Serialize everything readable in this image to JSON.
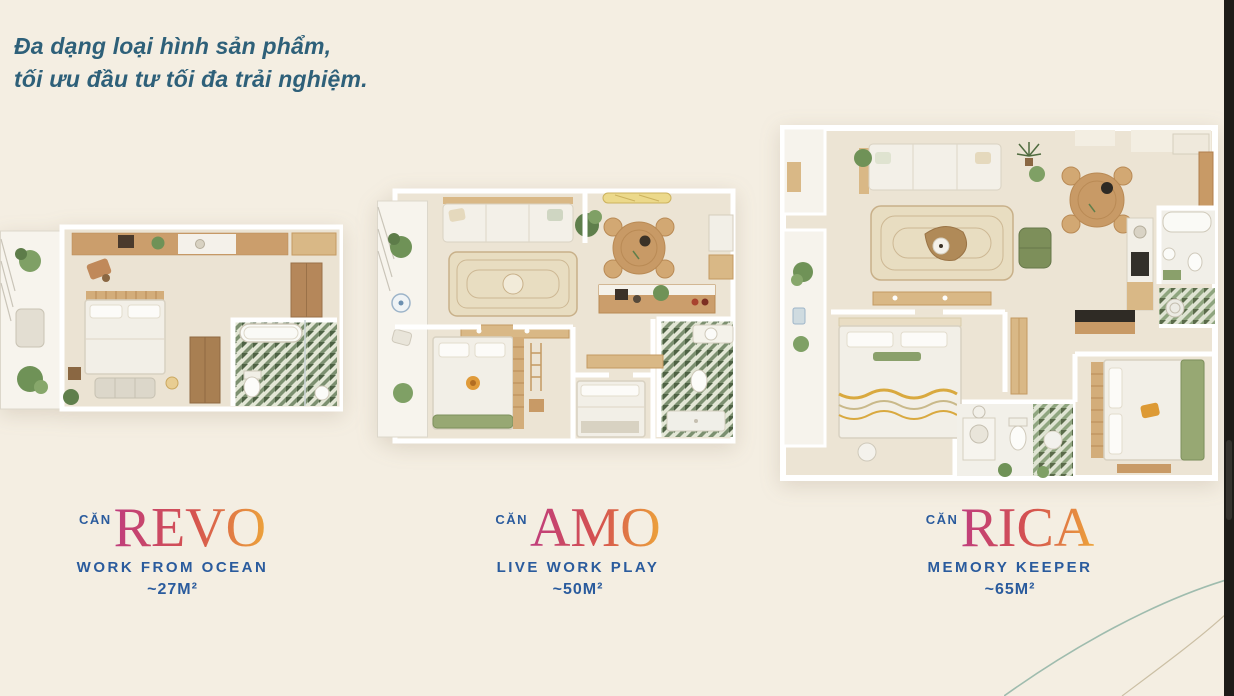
{
  "page": {
    "heading": {
      "line1": "Đa dạng loại hình sản phẩm,",
      "line2": "tối ưu đầu tư tối đa trải nghiệm."
    },
    "colors": {
      "page_bg": "#f4eee2",
      "heading_text": "#2e6079",
      "unit_blue": "#2a5b9d",
      "name_gradient_start": "#bf3d7e",
      "name_gradient_mid": "#d5524f",
      "name_gradient_end": "#eda43a",
      "decor_line": "#9fbcae",
      "dark_bar": "#1d1c18"
    }
  },
  "units": [
    {
      "prefix": "CĂN",
      "name": "REVO",
      "tagline": "WORK FROM OCEAN",
      "area": "~27M²",
      "plan_type": "studio-floorplan"
    },
    {
      "prefix": "CĂN",
      "name": "AMO",
      "tagline": "LIVE WORK PLAY",
      "area": "~50M²",
      "plan_type": "one-bedroom-floorplan"
    },
    {
      "prefix": "CĂN",
      "name": "RICA",
      "tagline": "MEMORY KEEPER",
      "area": "~65M²",
      "plan_type": "two-bedroom-floorplan"
    }
  ]
}
